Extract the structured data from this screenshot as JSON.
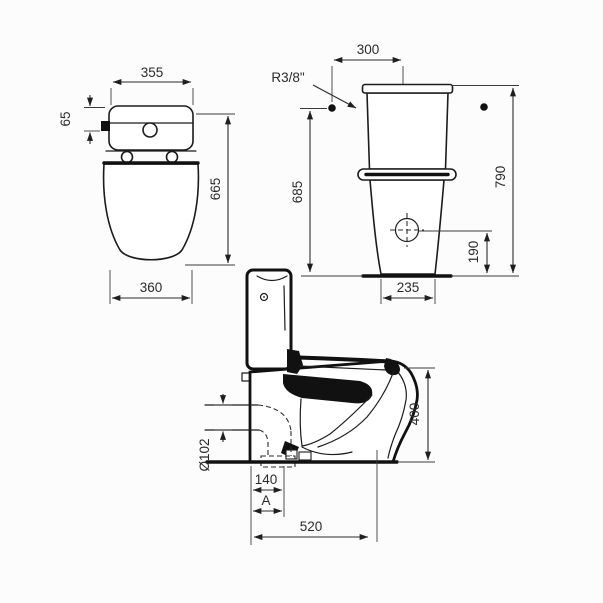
{
  "drawing": {
    "background_color": "#fcfcfc",
    "line_color": "#1c1c1c",
    "text_color": "#2b2b2b",
    "front_view": {
      "tank_width": "355",
      "inlet_offset": "65",
      "body_height": "665",
      "bowl_width": "360"
    },
    "rear_view": {
      "inlet_to_center": "300",
      "inlet_thread": "R3/8\"",
      "inlet_height": "685",
      "total_height": "790",
      "supply_hole_height": "190",
      "base_width": "235"
    },
    "side_view": {
      "rim_height": "400",
      "outlet_diameter": "Ø102",
      "outlet_setout": "140",
      "variable_setout": "A",
      "depth": "520"
    }
  }
}
